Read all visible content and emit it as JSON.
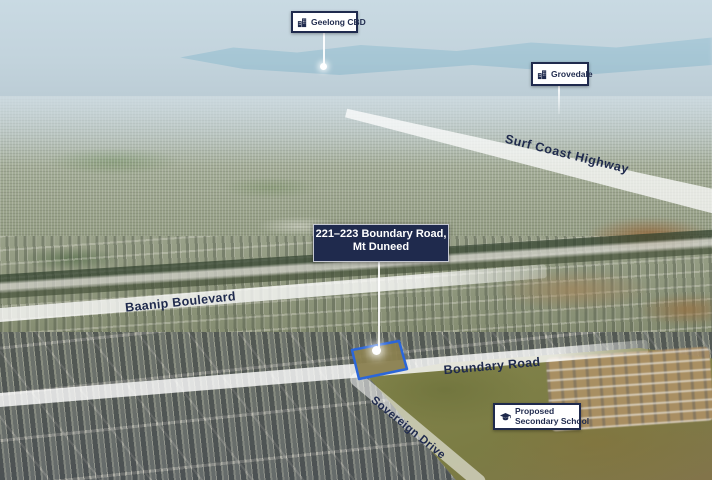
{
  "callouts": {
    "geelong_cbd": {
      "text": "Geelong CBD",
      "icon": "city-buildings"
    },
    "grovedale": {
      "text": "Grovedale",
      "icon": "city-buildings"
    },
    "property": {
      "line1": "221–223 Boundary Road,",
      "line2": "Mt Duneed"
    },
    "proposed_school": {
      "line1": "Proposed",
      "line2": "Secondary School",
      "icon": "graduation-cap"
    }
  },
  "road_labels": {
    "surf_coast_highway": "Surf Coast Highway",
    "baanip_boulevard": "Baanip Boulevard",
    "boundary_road": "Boundary Road",
    "sovereign_drive": "Sovereign Drive"
  },
  "colors": {
    "navy": "#1f2a4d",
    "callout_background": "#ffffff",
    "road_overlay": "#ffffff",
    "property_outline": "#2b66d9"
  }
}
